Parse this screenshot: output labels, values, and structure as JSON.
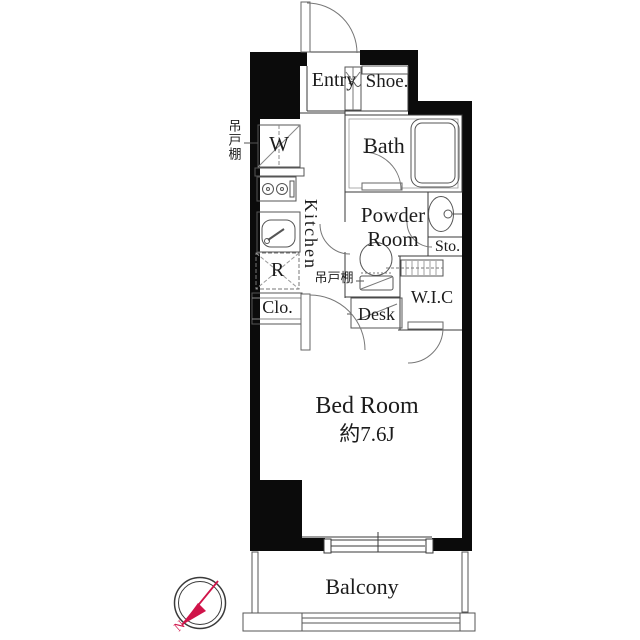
{
  "floorplan": {
    "rooms": {
      "entry": "Entry",
      "shoe": "Shoe.",
      "bath": "Bath",
      "powder_room_line1": "Powder",
      "powder_room_line2": "Room",
      "storage": "Sto.",
      "wic": "W.I.C",
      "desk": "Desk",
      "kitchen": "Kitchen",
      "closet": "Clo.",
      "refrigerator_mark": "R",
      "washer_mark": "W",
      "bedroom_name": "Bed Room",
      "bedroom_size": "約7.6J",
      "balcony": "Balcony"
    },
    "annotations": {
      "hanging_cupboard_left": "吊戸棚",
      "hanging_cupboard_kitchen": "吊戸棚",
      "compass_north": "N"
    },
    "colors": {
      "background": "#ffffff",
      "wall": "#0b0b0b",
      "partition_line": "#3a3a3a",
      "fixture_line": "#666666",
      "compass_red": "#d01349"
    }
  }
}
